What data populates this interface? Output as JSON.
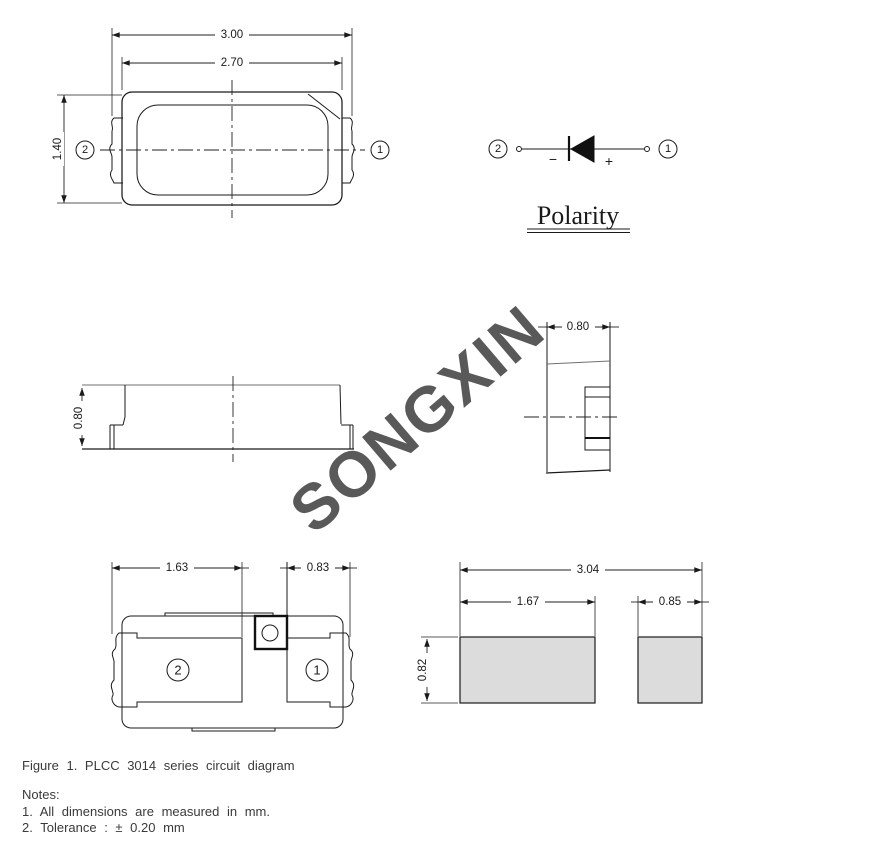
{
  "watermark": "SONGXIN",
  "top_view": {
    "dim_outer_width": "3.00",
    "dim_inner_width": "2.70",
    "dim_height": "1.40",
    "pin_left": "2",
    "pin_right": "1"
  },
  "polarity": {
    "pin_left": "2",
    "pin_right": "1",
    "minus": "−",
    "plus": "+",
    "label": "Polarity"
  },
  "side_view": {
    "dim_height": "0.80"
  },
  "end_view": {
    "dim_width": "0.80"
  },
  "bottom_view": {
    "dim_pad2_width": "1.63",
    "dim_pad1_width": "0.83",
    "pin_left": "2",
    "pin_right": "1"
  },
  "pad_layout": {
    "dim_total_width": "3.04",
    "dim_pad2_width": "1.67",
    "dim_pad1_width": "0.85",
    "dim_height": "0.82"
  },
  "caption": "Figure 1. PLCC 3014 series circuit diagram",
  "notes": {
    "title": "Notes:",
    "item1": "1. All dimensions are measured in mm.",
    "item2": "2. Tolerance : ± 0.20 mm"
  },
  "colors": {
    "line": "#1a1a1a",
    "pad_fill": "#dcdcdc",
    "watermark_gray": "#7d7d7d",
    "background": "#ffffff"
  }
}
